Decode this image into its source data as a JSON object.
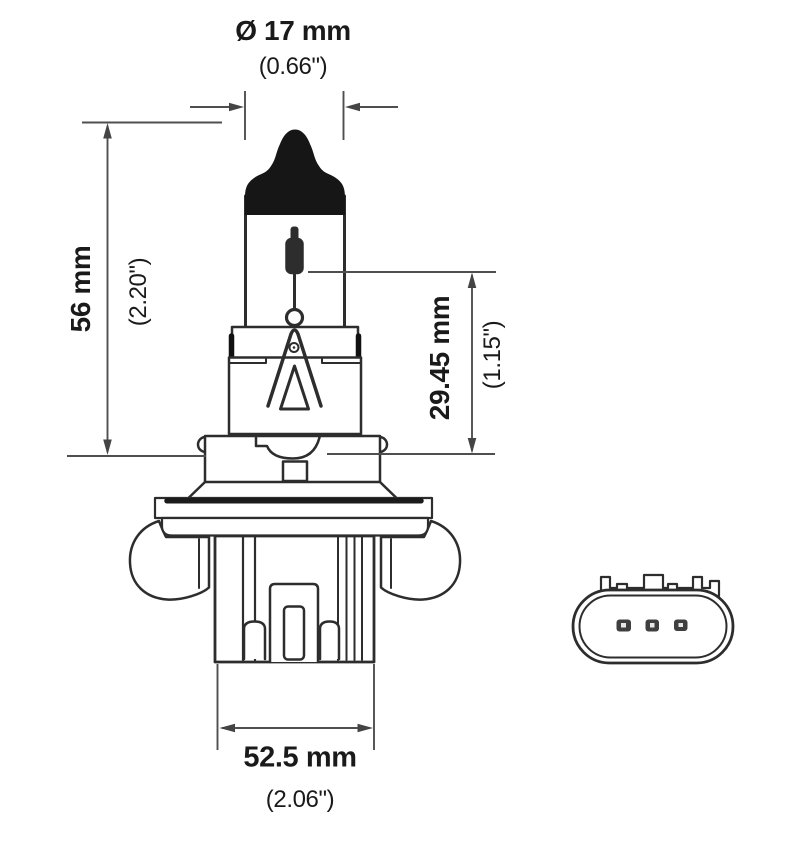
{
  "colors": {
    "background": "#ffffff",
    "drawing_line": "#2d2d2d",
    "dimension_line": "#4f4f4f",
    "label_text": "#1a1a1a",
    "painted_tip_fill": "#161616"
  },
  "dimensions": {
    "dim_top": {
      "metric": "Ø 17 mm",
      "imperial": "(0.66\")"
    },
    "dim_left": {
      "metric": "56 mm",
      "imperial": "(2.20\")"
    },
    "dim_right": {
      "metric": "29.45 mm",
      "imperial": "(1.15\")"
    },
    "dim_bottom": {
      "metric": "52.5 mm",
      "imperial": "(2.06\")"
    }
  }
}
